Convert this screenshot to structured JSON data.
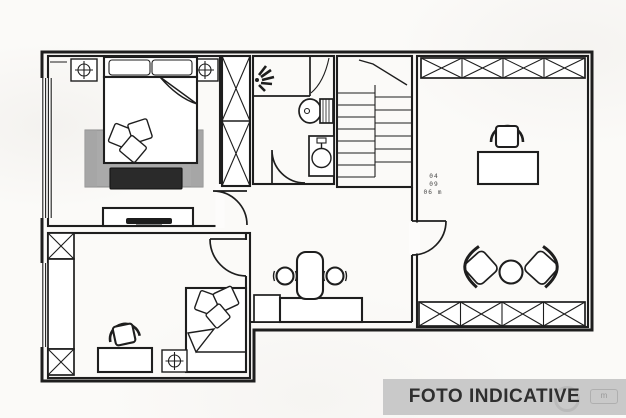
{
  "banner": {
    "label": "FOTO INDICATIVE"
  },
  "dimension_note": {
    "line1": "04",
    "line2": "09",
    "line3": "06 m"
  },
  "watermark": {
    "glyph": "m"
  },
  "colors": {
    "line": "#1e1e1e",
    "paper": "#fbfaf8",
    "banner_bg": "#c9c9c9",
    "banner_text": "#2f2f2f",
    "rug": "#bdbdbd",
    "rug_line": "#939393",
    "bench": "#2a2a2a",
    "dim_text": "#4a4a4a"
  },
  "symbols": {
    "ceiling_light": "crosshair-in-square",
    "wardrobe": "x-crossed-box",
    "door": "quarter-arc-swing",
    "window": "parallel-lines",
    "stairs": "tread-lines-with-break",
    "shower": "spray-fan",
    "toilet": "bowl-with-hatched-tank",
    "sink": "basin-circle-in-box"
  }
}
